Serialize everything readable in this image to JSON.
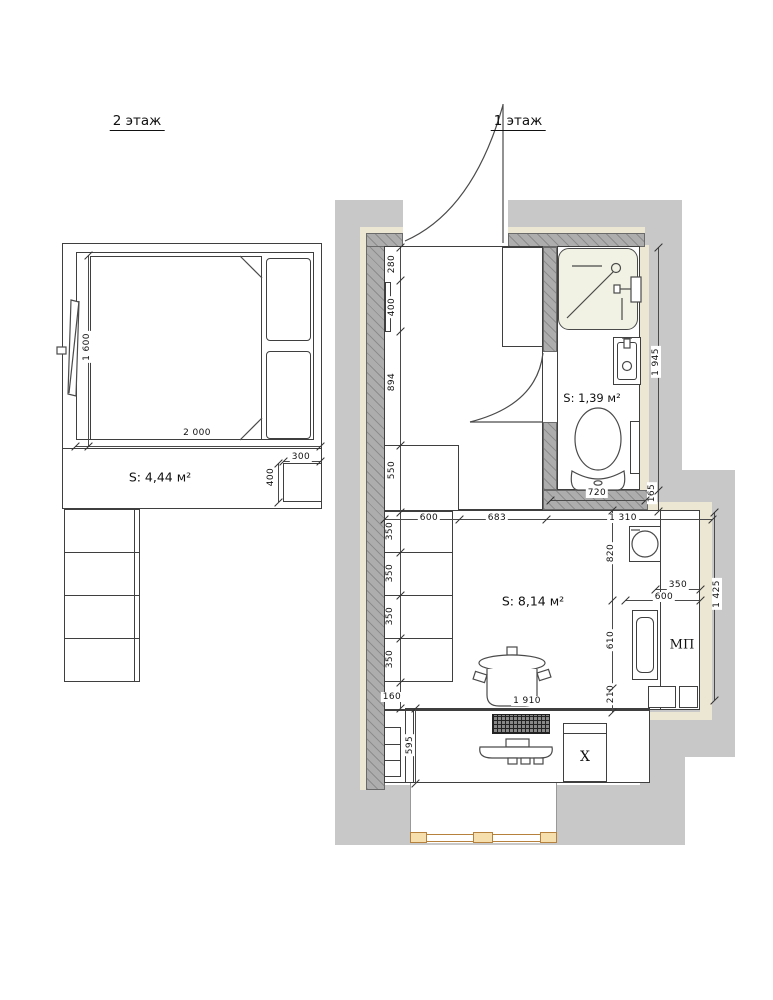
{
  "titles": {
    "floor2": "2 этаж",
    "floor1": "1 этаж"
  },
  "rooms": {
    "bedroom": {
      "label": "S: 4,44 м²"
    },
    "bathroom": {
      "label": "S: 1,39 м²"
    },
    "main": {
      "label": "S: 8,14 м²"
    }
  },
  "fixtures": {
    "fridge": "X",
    "dishwasher": "МП"
  },
  "icons": [
    "shower-tray-icon",
    "toilet-icon",
    "washbasin-icon",
    "towel-rail-icon",
    "washing-machine-icon",
    "kitchen-sink-icon",
    "cooking-pot-icon",
    "keyboard-icon",
    "monitor-icon",
    "door-swing-icon",
    "bed-icon",
    "stairs-icon",
    "window-icon"
  ],
  "colors": {
    "wall_light": "#c8c8c8",
    "wall_hatched": "#adadad",
    "lining": "#ebe7d3",
    "line": "#3f3f3f",
    "window_frame": "#b5813c",
    "window_fill": "#f6dfad",
    "shower_fill": "#f1f2e3"
  },
  "dimensions": [
    {
      "text": "1 600",
      "x": 87,
      "y": 347,
      "rot": true
    },
    {
      "text": "2 000",
      "x": 197,
      "y": 433,
      "rot": false
    },
    {
      "text": "300",
      "x": 301,
      "y": 457,
      "rot": false
    },
    {
      "text": "400",
      "x": 271,
      "y": 477,
      "rot": true
    },
    {
      "text": "280",
      "x": 392,
      "y": 264,
      "rot": true
    },
    {
      "text": "400",
      "x": 392,
      "y": 307,
      "rot": true
    },
    {
      "text": "894",
      "x": 392,
      "y": 382,
      "rot": true
    },
    {
      "text": "550",
      "x": 392,
      "y": 470,
      "rot": true
    },
    {
      "text": "350",
      "x": 390,
      "y": 531,
      "rot": true
    },
    {
      "text": "350",
      "x": 390,
      "y": 573,
      "rot": true
    },
    {
      "text": "350",
      "x": 390,
      "y": 616,
      "rot": true
    },
    {
      "text": "350",
      "x": 390,
      "y": 659,
      "rot": true
    },
    {
      "text": "160",
      "x": 392,
      "y": 697,
      "rot": false
    },
    {
      "text": "595",
      "x": 410,
      "y": 745,
      "rot": true
    },
    {
      "text": "600",
      "x": 429,
      "y": 518,
      "rot": false
    },
    {
      "text": "683",
      "x": 497,
      "y": 518,
      "rot": false
    },
    {
      "text": "1 310",
      "x": 623,
      "y": 518,
      "rot": false
    },
    {
      "text": "720",
      "x": 597,
      "y": 493,
      "rot": false
    },
    {
      "text": "820",
      "x": 611,
      "y": 553,
      "rot": true
    },
    {
      "text": "610",
      "x": 611,
      "y": 640,
      "rot": true
    },
    {
      "text": "210",
      "x": 611,
      "y": 694,
      "rot": true
    },
    {
      "text": "350",
      "x": 678,
      "y": 585,
      "rot": false
    },
    {
      "text": "600",
      "x": 664,
      "y": 597,
      "rot": false
    },
    {
      "text": "1 945",
      "x": 656,
      "y": 362,
      "rot": true
    },
    {
      "text": "165",
      "x": 652,
      "y": 493,
      "rot": true
    },
    {
      "text": "1 425",
      "x": 717,
      "y": 594,
      "rot": true
    },
    {
      "text": "1 910",
      "x": 527,
      "y": 701,
      "rot": false
    }
  ]
}
